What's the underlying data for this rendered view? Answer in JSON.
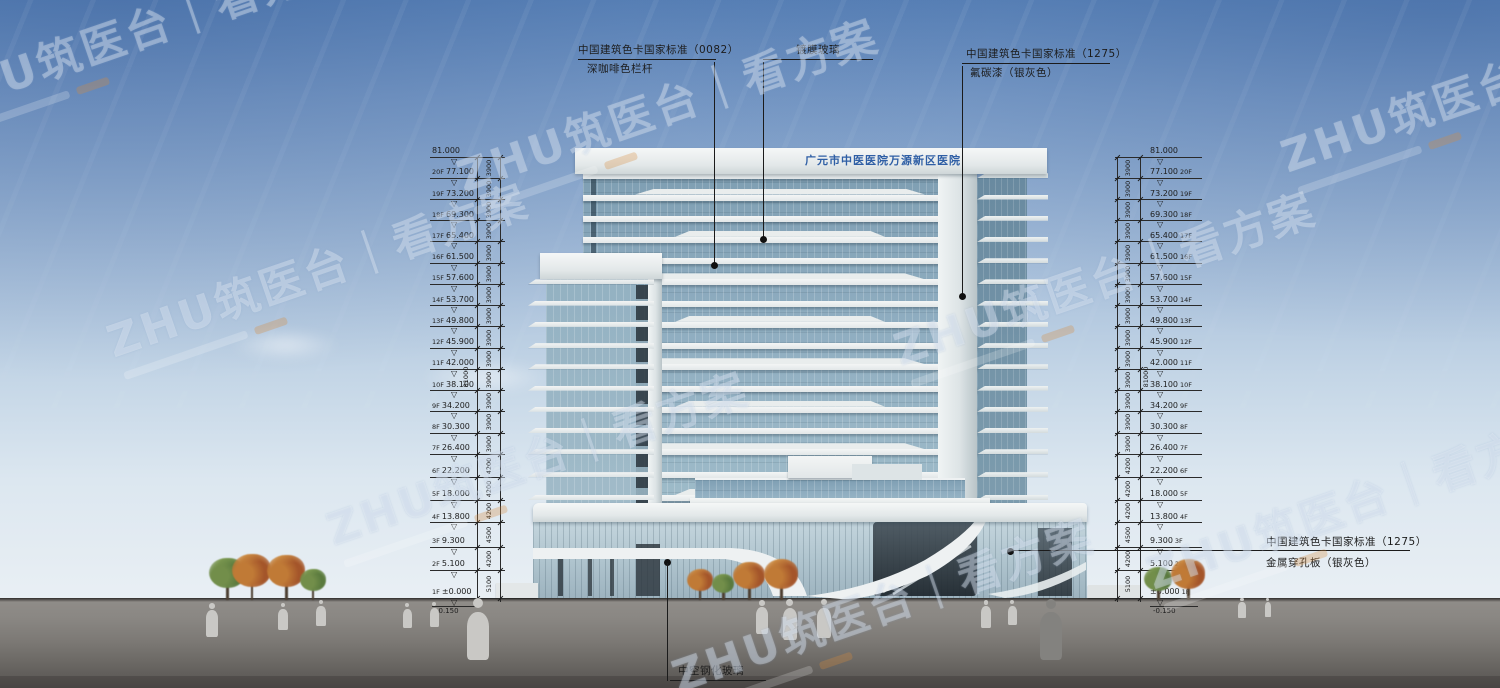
{
  "title_sign": "广元市中医医院万源新区医院",
  "annotations": {
    "railing": {
      "line1": "中国建筑色卡国家标准（0082）",
      "line2": "深咖啡色栏杆"
    },
    "coated_glass": {
      "label": "镀膜玻璃"
    },
    "fluorocarbon": {
      "line1": "中国建筑色卡国家标准（1275）",
      "line2": "氟碳漆（银灰色）"
    },
    "perforated_panel": {
      "line1": "中国建筑色卡国家标准（1275）",
      "line2": "金属穿孔板（银灰色）"
    },
    "insulated_glass": {
      "label": "中空钢化玻璃"
    }
  },
  "watermark": {
    "text": "ZHU筑医台｜看方案"
  },
  "levels": {
    "top": {
      "floor": "",
      "value": "81.000",
      "elev": 81.0
    },
    "floors": [
      {
        "floor": "20F",
        "value": "77.100",
        "elev": 77.1
      },
      {
        "floor": "19F",
        "value": "73.200",
        "elev": 73.2
      },
      {
        "floor": "18F",
        "value": "69.300",
        "elev": 69.3
      },
      {
        "floor": "17F",
        "value": "65.400",
        "elev": 65.4
      },
      {
        "floor": "16F",
        "value": "61.500",
        "elev": 61.5
      },
      {
        "floor": "15F",
        "value": "57.600",
        "elev": 57.6
      },
      {
        "floor": "14F",
        "value": "53.700",
        "elev": 53.7
      },
      {
        "floor": "13F",
        "value": "49.800",
        "elev": 49.8
      },
      {
        "floor": "12F",
        "value": "45.900",
        "elev": 45.9
      },
      {
        "floor": "11F",
        "value": "42.000",
        "elev": 42.0
      },
      {
        "floor": "10F",
        "value": "38.100",
        "elev": 38.1
      },
      {
        "floor": "9F",
        "value": "34.200",
        "elev": 34.2
      },
      {
        "floor": "8F",
        "value": "30.300",
        "elev": 30.3
      },
      {
        "floor": "7F",
        "value": "26.400",
        "elev": 26.4
      },
      {
        "floor": "6F",
        "value": "22.200",
        "elev": 22.2
      },
      {
        "floor": "5F",
        "value": "18.000",
        "elev": 18.0
      },
      {
        "floor": "4F",
        "value": "13.800",
        "elev": 13.8
      },
      {
        "floor": "3F",
        "value": "9.300",
        "elev": 9.3
      },
      {
        "floor": "2F",
        "value": "5.100",
        "elev": 5.1
      },
      {
        "floor": "1F",
        "value": "±0.000",
        "elev": 0.0
      }
    ],
    "below_grade": {
      "value": "-0.150",
      "elev": -0.15
    },
    "floor_dims": [
      "3900",
      "3900",
      "3900",
      "3900",
      "3900",
      "3900",
      "3900",
      "3900",
      "3900",
      "3900",
      "3900",
      "3900",
      "3900",
      "3900",
      "4200",
      "4200",
      "4200",
      "4500",
      "4200",
      "5100"
    ],
    "overall_dim": "81000"
  },
  "colors": {
    "sky_top": "#5d86bb",
    "sky_horizon": "#e9eff4",
    "ground_gray": "#7c7975",
    "glass_blue": "#8fadc0",
    "slab_white": "#eef1f2",
    "sign_blue": "#2f5fa5",
    "annotation_ink": "#1c1c1c",
    "tree_green": "#5f7d3f",
    "tree_orange": "#b8622f",
    "watermark_white": "#ffffff"
  }
}
